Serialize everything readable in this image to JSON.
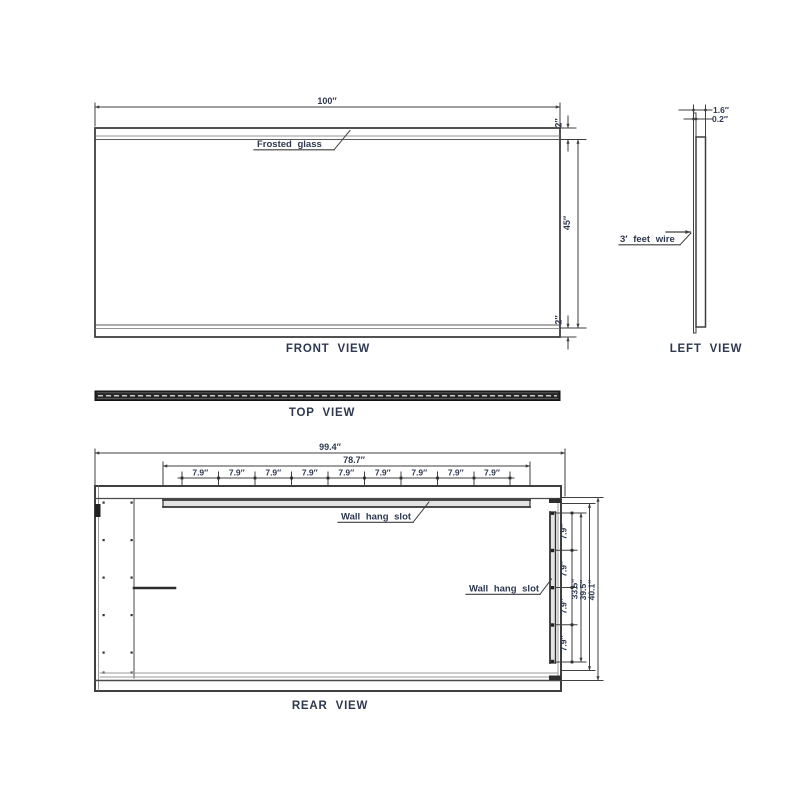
{
  "page": {
    "background": "#ffffff",
    "ink_color": "#2e3950",
    "line_color": "#3f3f3f",
    "topbar_color": "#262626"
  },
  "front_view": {
    "title": "FRONT VIEW",
    "width": "100″",
    "glass_label": "Frosted glass",
    "top_frame": "2″",
    "height": "45″",
    "bottom_frame": "2″"
  },
  "left_view": {
    "title": "LEFT VIEW",
    "thickness_total": "1.6″",
    "thickness_glass": "0.2″",
    "wire_label": "3′ feet wire"
  },
  "top_view": {
    "title": "TOP VIEW"
  },
  "rear_view": {
    "title": "REAR VIEW",
    "overall_width": "99.4″",
    "rail_width": "78.7″",
    "top_slot_label": "Wall hang slot",
    "side_slot_label": "Wall hang slot",
    "top_spacing": [
      "7.9″",
      "7.9″",
      "7.9″",
      "7.9″",
      "7.9″",
      "7.9″",
      "7.9″",
      "7.9″",
      "7.9″"
    ],
    "side_spacing": [
      "7.9″",
      "7.9″",
      "7.9″",
      "7.9″"
    ],
    "slot_height": "33.5″",
    "inner_height": "39.5″",
    "overall_height": "40.1″"
  }
}
